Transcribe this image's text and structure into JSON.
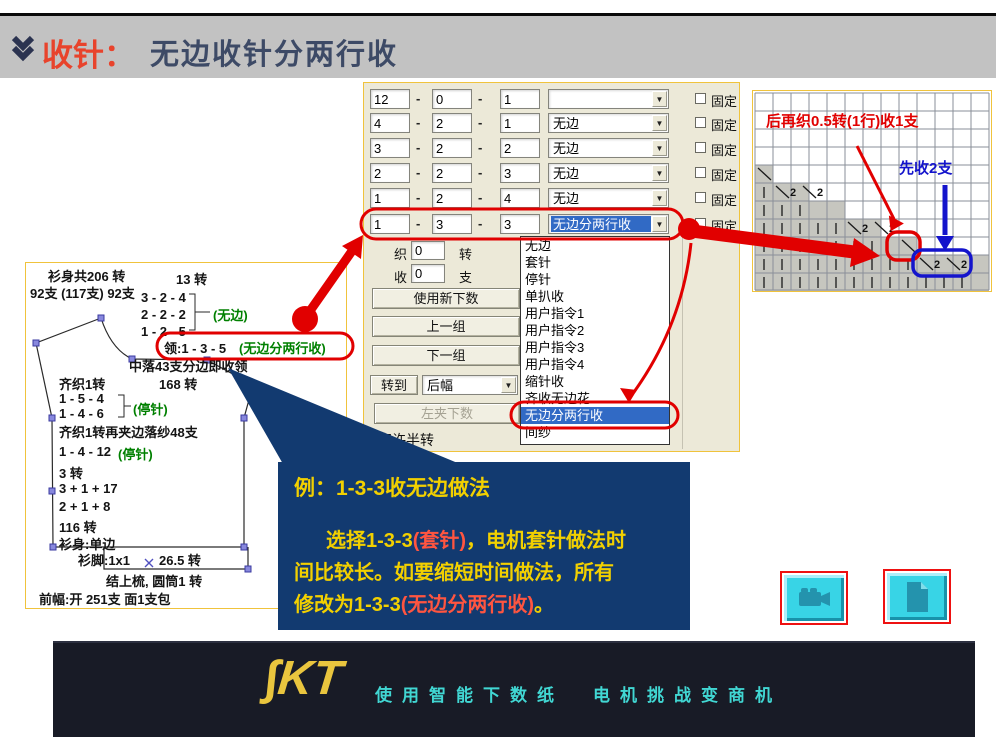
{
  "header": {
    "title_red": "收针：",
    "title_main": "无边收针分两行收"
  },
  "left_panel": {
    "l1": "衫身共206 转",
    "l2": "92支 (117支) 92支",
    "r1": "13 转",
    "r2": "3 - 2 - 4",
    "r3": "2 - 2 - 2",
    "r3g": "(无边)",
    "r4": "1 - 2 - 5",
    "neck_black": "领:1 - 3 - 5",
    "neck_green": "(无边分两行收)",
    "mid": "中落43支分边即收领",
    "q1": "齐织1转",
    "q1b": "168 转",
    "s1": "1 - 5 - 4",
    "s2": "1 - 4 - 6",
    "s2g": "(停针)",
    "q2": "齐织1转再夹边落纱48支",
    "s3": "1 - 4 - 12",
    "s3g": "(停针)",
    "s4": "3 转",
    "s5": "3 + 1 + 17",
    "s6": "2 + 1 + 8",
    "s7": "116 转",
    "s8": "衫身:单边",
    "foot1": "衫脚:1x1",
    "foot1c": "26.5 转",
    "foot2": "结上梳, 圆筒1 转",
    "foot3": "前幅:开 251支 面1支包"
  },
  "dialog": {
    "sep": "-",
    "fixed": "固定",
    "rows": [
      {
        "a": "12",
        "b": "0",
        "c": "1",
        "combo": ""
      },
      {
        "a": "4",
        "b": "2",
        "c": "1",
        "combo": "无边"
      },
      {
        "a": "3",
        "b": "2",
        "c": "2",
        "combo": "无边"
      },
      {
        "a": "2",
        "b": "2",
        "c": "3",
        "combo": "无边"
      },
      {
        "a": "1",
        "b": "2",
        "c": "4",
        "combo": "无边"
      },
      {
        "a": "1",
        "b": "3",
        "c": "3",
        "combo": "无边分两行收"
      }
    ],
    "weave_label": "织",
    "weave_val": "0",
    "weave_unit": "转",
    "dec_label": "收",
    "dec_val": "0",
    "dec_unit": "支",
    "btn_new": "使用新下数",
    "btn_prev": "上一组",
    "btn_next": "下一组",
    "btn_goto": "转到",
    "goto_val": "后幅",
    "btn_leftclamp": "左夹下数",
    "allow_half": "容许半转"
  },
  "dropdown": {
    "items": [
      "无边",
      "套针",
      "停针",
      "单扒收",
      "用户指令1",
      "用户指令2",
      "用户指令3",
      "用户指令4",
      "缩针收",
      "齐收无边花",
      "无边分两行收",
      "间纱"
    ],
    "selected": "无边分两行收"
  },
  "grid": {
    "label_red": "后再织0.5转(1行)收1支",
    "label_blue": "先收2支",
    "two": "2"
  },
  "callout": {
    "line1": "例：1-3-3收无边做法",
    "line2_a": "选择1-3-3",
    "line2_red": "(套针)",
    "line2_b": "，电机套针做法时",
    "line3": "间比较长。如要缩短时间做法，所有",
    "line4_a": "修改为1-3-3",
    "line4_red": "(无边分两行收)",
    "line4_b": "。"
  },
  "footer": {
    "logo": "∫KT",
    "tag1": "使用智能下数纸",
    "tag2": "电机挑战变商机"
  },
  "icons": {
    "combo_arrow": "▼"
  },
  "colors": {
    "accent_red": "#e10000",
    "accent_blue": "#1414cc",
    "green": "#008000",
    "selection": "#316ac5",
    "callout_bg": "#123a70",
    "callout_yellow": "#f2d000",
    "callout_red": "#ff5540",
    "footer_bg": "#181b26",
    "cyan": "#38d4e6",
    "panel_border": "#f0c33c"
  }
}
